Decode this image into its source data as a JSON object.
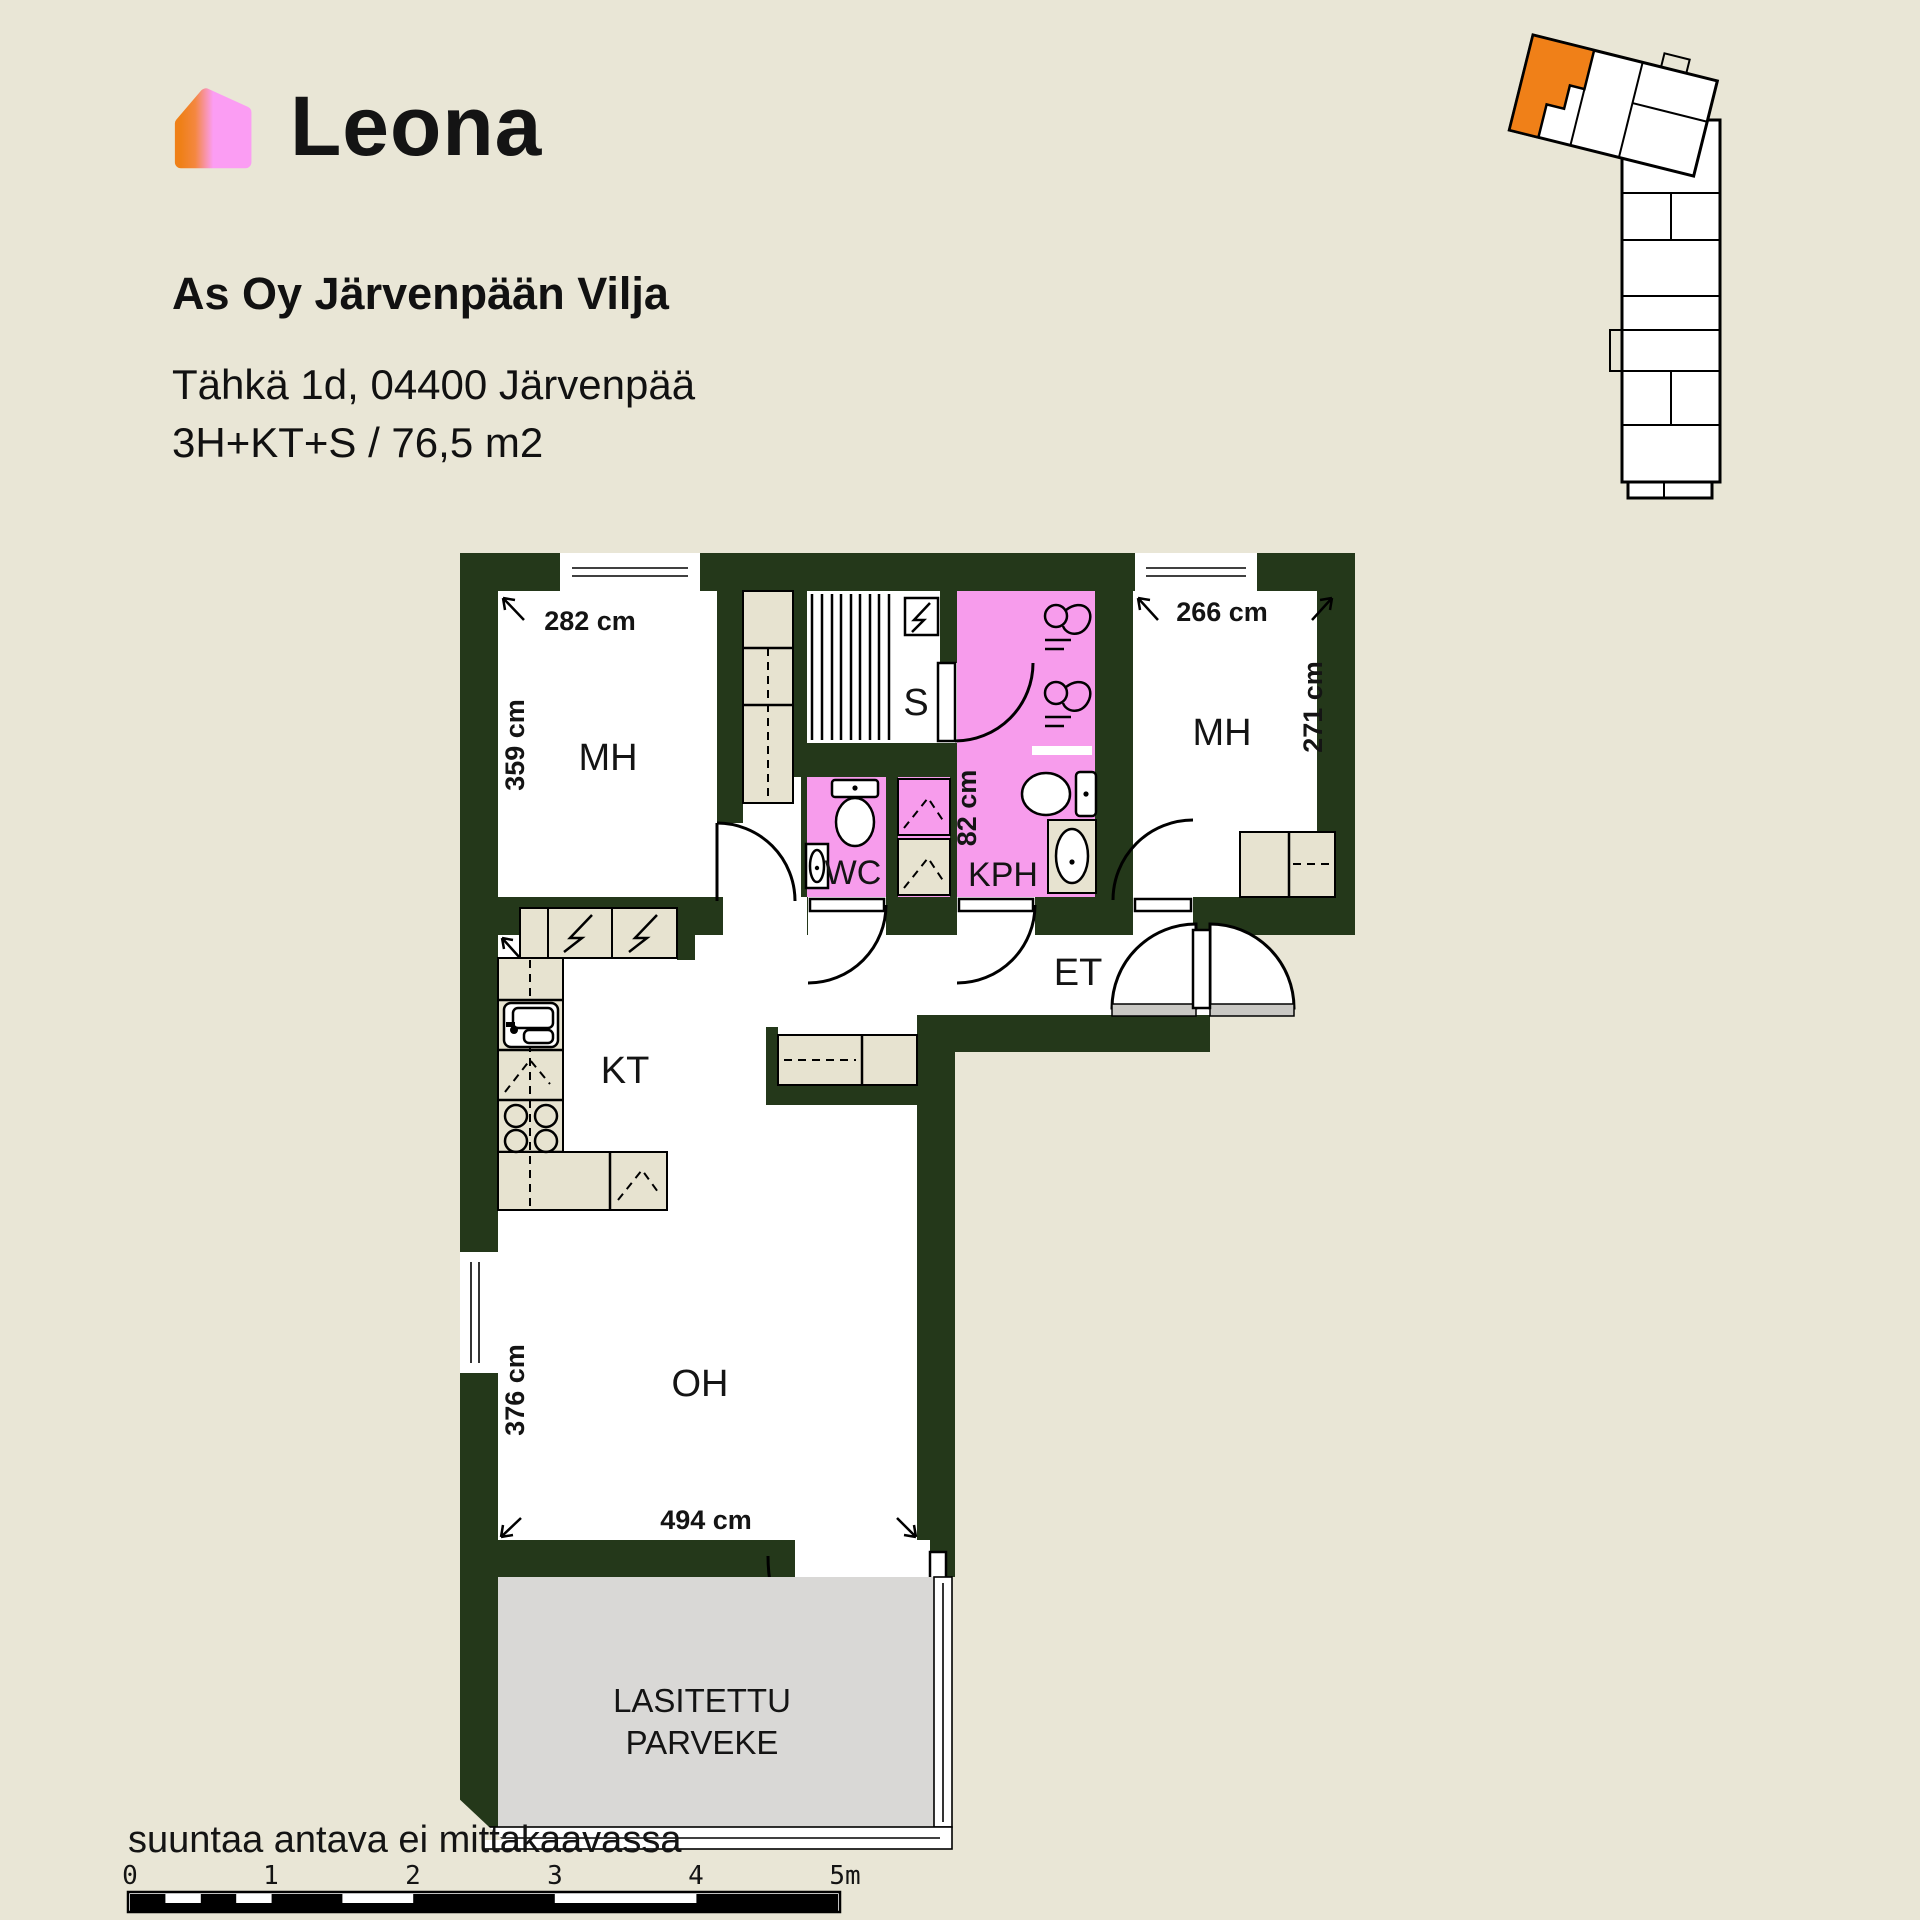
{
  "header": {
    "logo_text": "Leona",
    "project": "As Oy Järvenpään Vilja",
    "address": "Tähkä 1d, 04400 Järvenpää",
    "unit_info": "3H+KT+S / 76,5 m2"
  },
  "plan": {
    "rooms": {
      "mh1": "MH",
      "mh2": "MH",
      "sauna": "S",
      "wc": "WC",
      "bathroom": "KPH",
      "hallway": "ET",
      "kitchen": "KT",
      "living": "OH",
      "balcony_line1": "LASITETTU",
      "balcony_line2": "PARVEKE"
    },
    "dimensions": {
      "mh1_width": "282 cm",
      "mh1_depth": "359 cm",
      "mh2_width": "266 cm",
      "mh2_depth": "271 cm",
      "bath_width": "82 cm",
      "living_width": "494 cm",
      "living_depth": "376 cm"
    },
    "colors": {
      "wall": "#24381a",
      "wet": "#f79cec",
      "fx": "#e7e3d0",
      "balcony": "#d9d8d6",
      "highlight": "#f08018",
      "bg": "#e9e6d6",
      "logo_pink": "#fb9df3",
      "logo_orange": "#ef8018"
    }
  },
  "footer": {
    "note": "suuntaa antava ei mittakaavassa",
    "scale": [
      "0",
      "1",
      "2",
      "3",
      "4",
      "5m"
    ]
  }
}
